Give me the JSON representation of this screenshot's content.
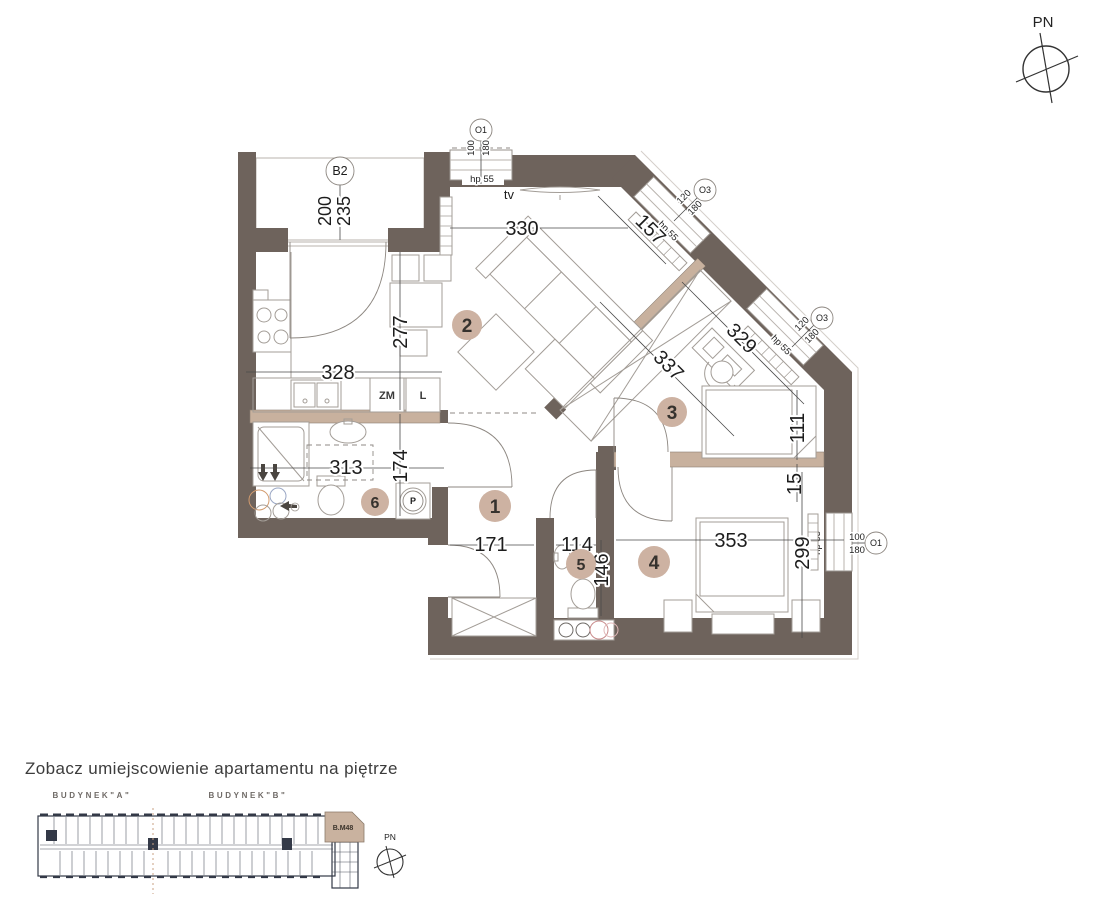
{
  "colors": {
    "wall": "#6e635c",
    "accent": "#c8b19e",
    "badge": "#cdb2a2",
    "highlight": "#c9b29f"
  },
  "compass": {
    "label": "PN"
  },
  "plan": {
    "rooms": [
      {
        "number": "1"
      },
      {
        "number": "2"
      },
      {
        "number": "3"
      },
      {
        "number": "4"
      },
      {
        "number": "5"
      },
      {
        "number": "6"
      }
    ],
    "balcony": {
      "label": "B2",
      "width": "200",
      "depth": "235"
    },
    "labels": {
      "tv": "tv",
      "dishwasher": "ZM",
      "fridge": "L",
      "washer": "P"
    },
    "windows": [
      {
        "id": "O1",
        "width": "100",
        "height": "180",
        "sill": "hp 55"
      },
      {
        "id": "O3",
        "width": "120",
        "height": "180",
        "sill": "hp 55"
      },
      {
        "id": "O3",
        "width": "120",
        "height": "180",
        "sill": "hp 55"
      },
      {
        "id": "O1",
        "width": "100",
        "height": "180",
        "sill": "hp 55"
      }
    ],
    "dimensions": {
      "living_width": "330",
      "living_diagonal": "157",
      "kitchen_width": "328",
      "kitchen_depth": "277",
      "room3_depth": "337",
      "room3_width": "329",
      "room3_bed_side": "111",
      "wall_gap": "15",
      "room4_width": "353",
      "room4_depth": "299",
      "bath_width": "313",
      "bath_depth": "174",
      "hall_width": "171",
      "wc_width": "114",
      "wc_depth": "146"
    }
  },
  "footer": {
    "heading": "Zobacz umiejscowienie apartamentu na piętrze",
    "building_a": "BUDYNEK\"A\"",
    "building_b": "BUDYNEK\"B\"",
    "unit": "B.M48",
    "compass_label": "PN"
  }
}
